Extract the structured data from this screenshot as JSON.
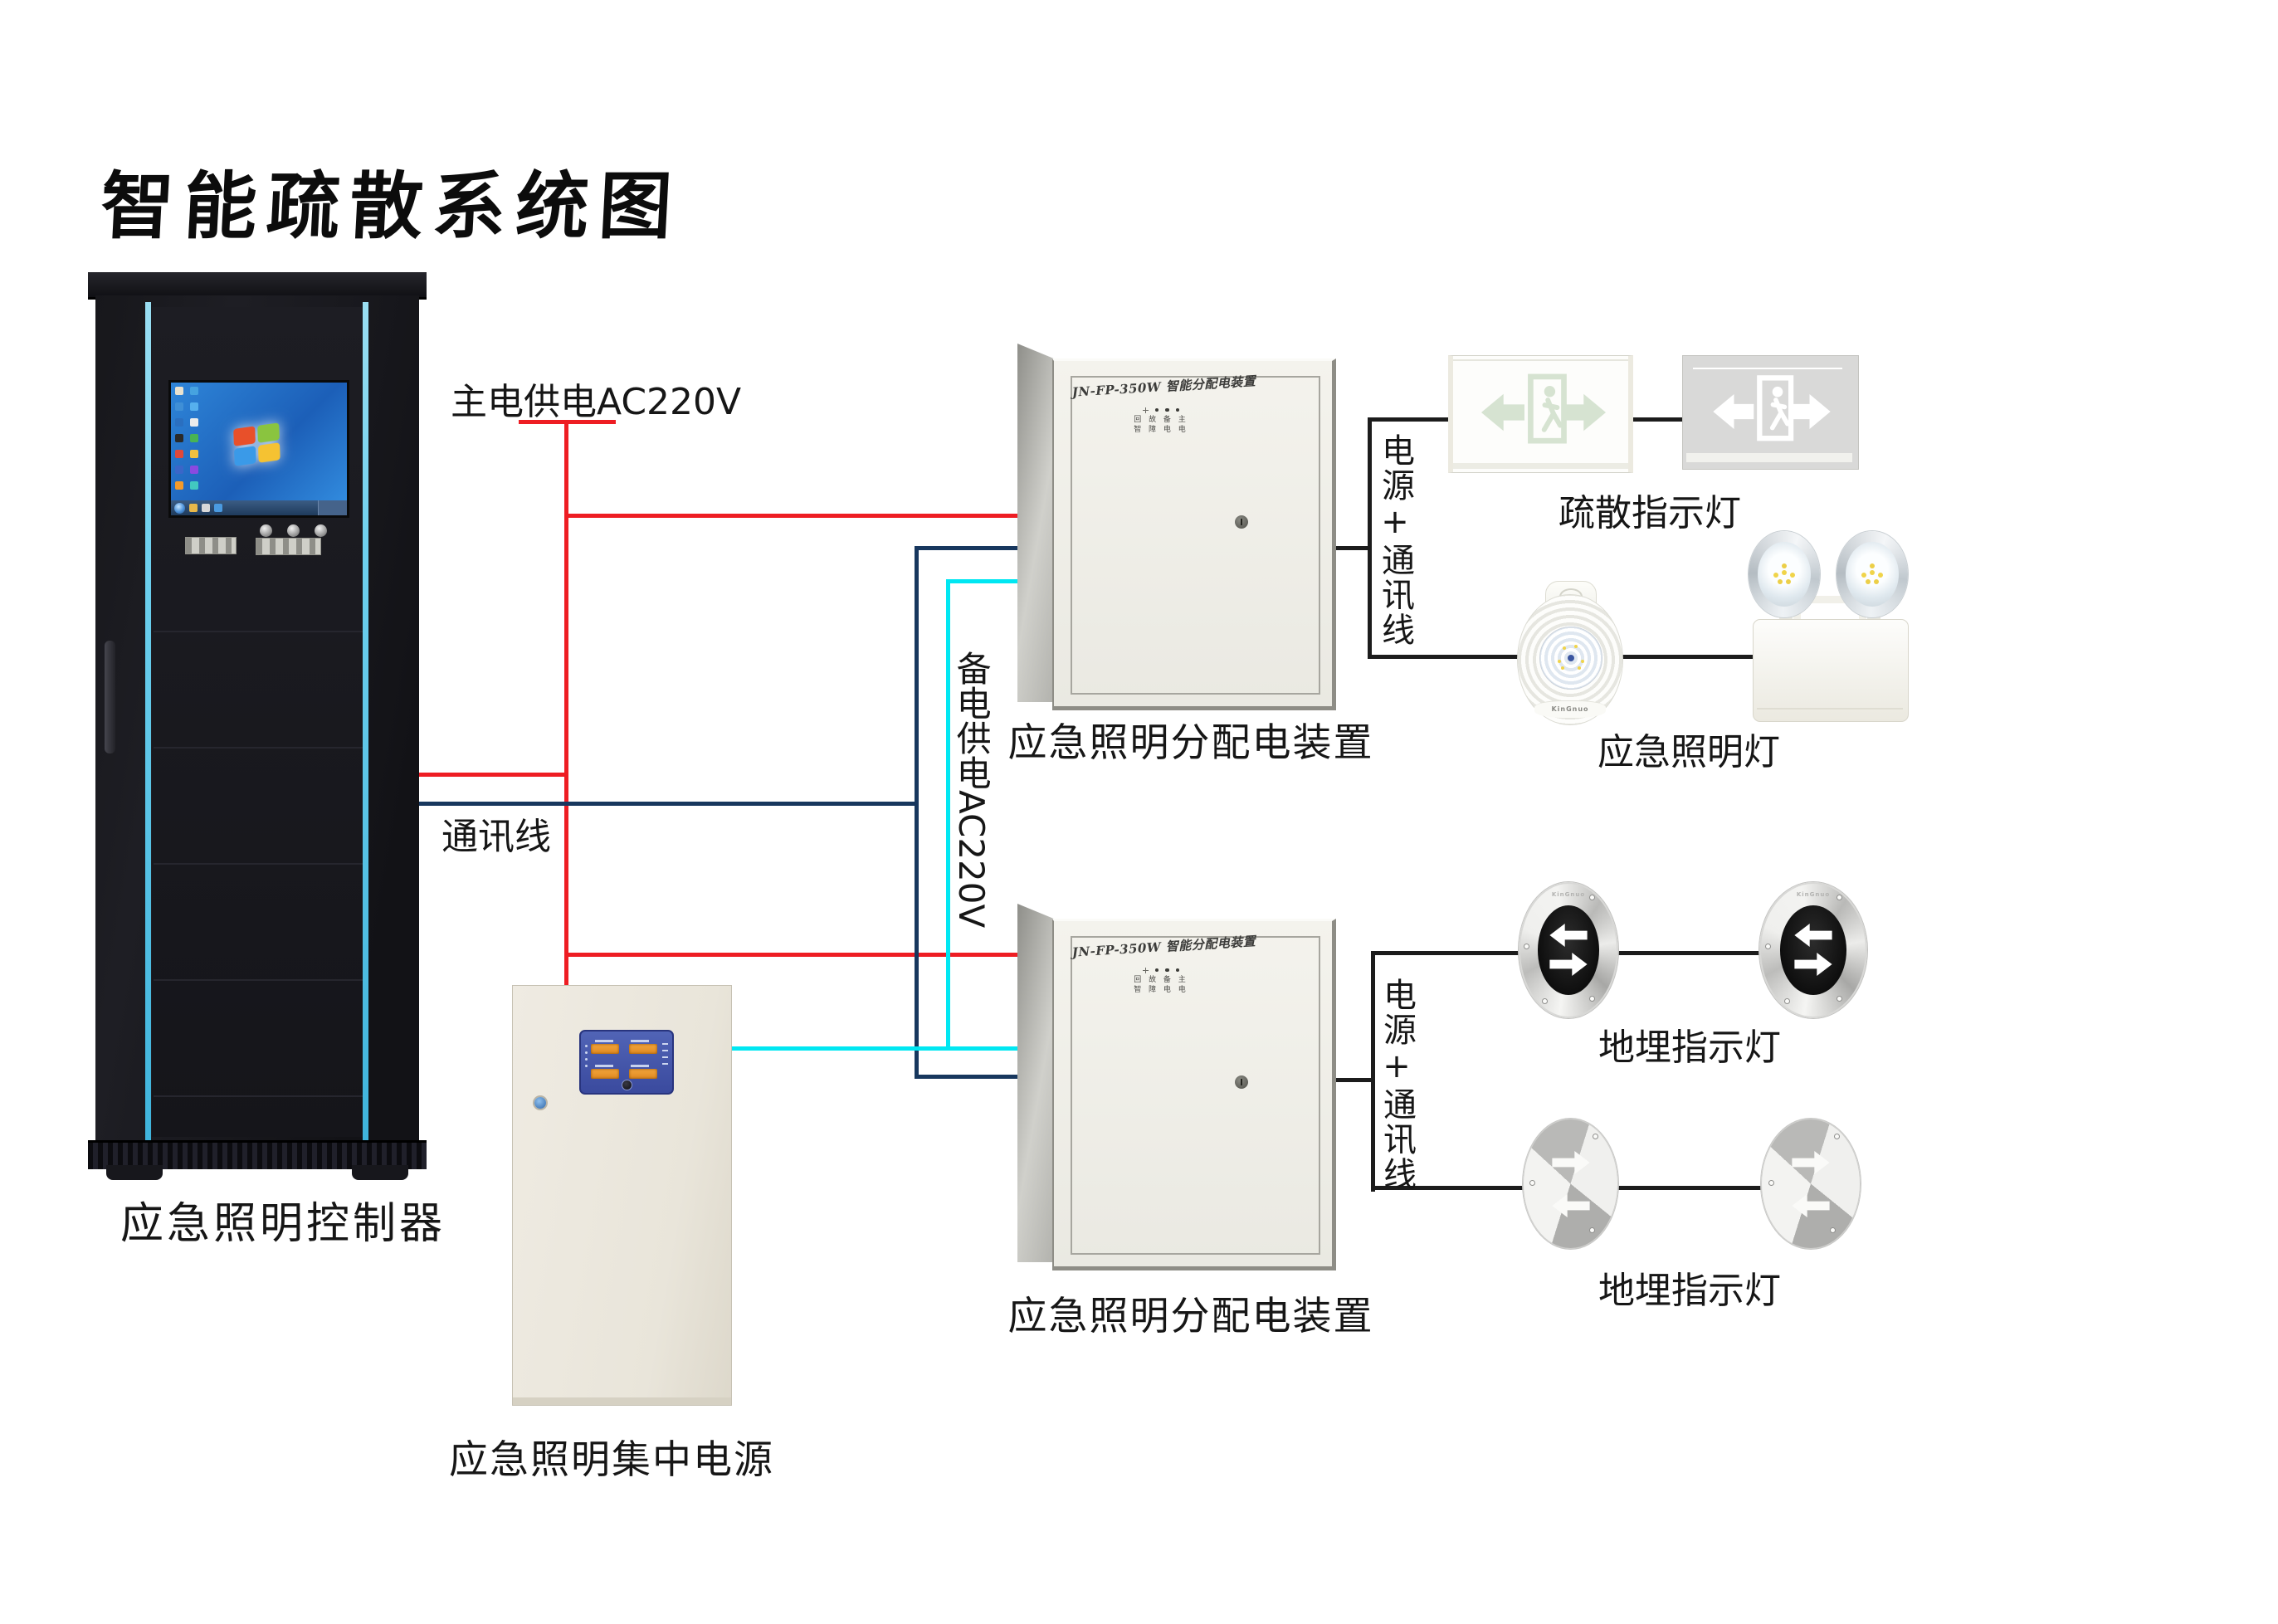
{
  "title": "智能疏散系统图",
  "colors": {
    "main_power_wire": "#ee1d23",
    "backup_power_wire": "#00e7f2",
    "communication_wire": "#17375e",
    "device_wire": "#1c1c1c",
    "cabinet_strip": "#6ed0ee"
  },
  "cabinet": {
    "label": "应急照明控制器"
  },
  "power_supply": {
    "label": "应急照明集中电源"
  },
  "distribution_box": {
    "header": "JN-FP-350W 智能分配电装置",
    "label": "应急照明分配电装置",
    "led_row_top": "回 故 备 主",
    "led_row_bottom": "智 障 电 电"
  },
  "wires": {
    "main_power_label": "主电供电AC220V",
    "comm_label": "通讯线",
    "backup_power_label": "备电供电AC220V",
    "power_comm_label": "电源+通讯线"
  },
  "devices": {
    "exit_sign_label": "疏散指示灯",
    "emergency_light_label": "应急照明灯",
    "buried_light_label": "地埋指示灯",
    "brand": "KinGnuo"
  }
}
